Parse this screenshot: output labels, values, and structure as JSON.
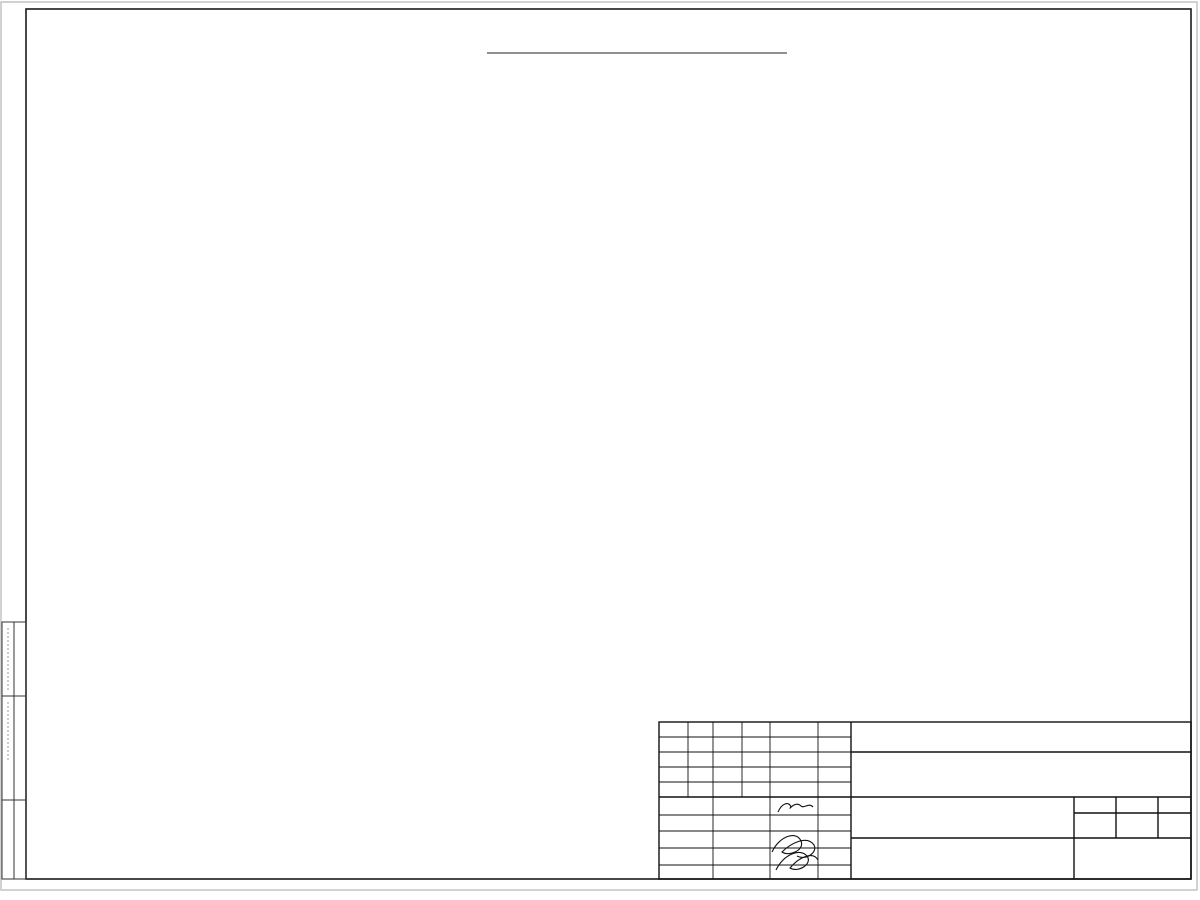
{
  "sheet": {
    "title": "Монтажный план этажа на отм. +3.480"
  },
  "axes": {
    "rows": [
      {
        "label": "Д",
        "y": 131
      },
      {
        "label": "Г",
        "y": 245
      },
      {
        "label": "В",
        "y": 358
      },
      {
        "label": "Б",
        "y": 471
      },
      {
        "label": "А",
        "y": 584
      }
    ],
    "cols": [
      {
        "label": "1",
        "x": 347
      },
      {
        "label": "2",
        "x": 438
      },
      {
        "label": "3",
        "x": 537
      },
      {
        "label": "4",
        "x": 623
      },
      {
        "label": "5",
        "x": 655
      },
      {
        "label": "6",
        "x": 738
      },
      {
        "label": "7",
        "x": 846
      },
      {
        "label": "8",
        "x": 953
      }
    ]
  },
  "dims": {
    "h": [
      {
        "t": "720",
        "x": 336,
        "y": 79
      },
      {
        "t": "1500",
        "x": 369,
        "y": 79
      },
      {
        "t": "1800",
        "x": 419,
        "y": 79
      },
      {
        "t": "1500",
        "x": 468,
        "y": 79
      },
      {
        "t": "1800",
        "x": 518,
        "y": 79
      },
      {
        "t": "1500",
        "x": 567,
        "y": 79
      },
      {
        "t": "1820",
        "x": 617,
        "y": 79
      },
      {
        "t": "1500",
        "x": 667,
        "y": 79
      },
      {
        "t": "1190",
        "x": 708,
        "y": 79
      },
      {
        "t": "1460",
        "x": 748,
        "y": 79
      },
      {
        "t": "4500",
        "x": 838,
        "y": 79
      },
      {
        "t": "1090",
        "x": 922,
        "y": 79
      },
      {
        "t": "230",
        "x": 729,
        "y": 119
      },
      {
        "t": "1000",
        "x": 760,
        "y": 119
      },
      {
        "t": "2820",
        "x": 687,
        "y": 157
      },
      {
        "t": "1780",
        "x": 763,
        "y": 157
      },
      {
        "t": "5400",
        "x": 872,
        "y": 157
      },
      {
        "t": "100",
        "x": 759,
        "y": 174
      },
      {
        "t": "100",
        "x": 815,
        "y": 174
      },
      {
        "t": "2000",
        "x": 770,
        "y": 509
      },
      {
        "t": "5180",
        "x": 876,
        "y": 509
      },
      {
        "t": "100",
        "x": 822,
        "y": 497
      },
      {
        "t": "950",
        "x": 748,
        "y": 566
      },
      {
        "t": "950",
        "x": 776,
        "y": 566
      },
      {
        "t": "100",
        "x": 782,
        "y": 554
      },
      {
        "t": "720",
        "x": 320,
        "y": 584
      },
      {
        "t": "720",
        "x": 336,
        "y": 605
      },
      {
        "t": "1500",
        "x": 369,
        "y": 605
      },
      {
        "t": "1800",
        "x": 418,
        "y": 605
      },
      {
        "t": "1500",
        "x": 468,
        "y": 605
      },
      {
        "t": "1800",
        "x": 517,
        "y": 605
      },
      {
        "t": "1500",
        "x": 566,
        "y": 605
      },
      {
        "t": "1800",
        "x": 616,
        "y": 605
      },
      {
        "t": "1500",
        "x": 665,
        "y": 605
      },
      {
        "t": "5600",
        "x": 774,
        "y": 605
      },
      {
        "t": "1500",
        "x": 881,
        "y": 605
      },
      {
        "t": "1160",
        "x": 921,
        "y": 605
      },
      {
        "t": "3000",
        "x": 392,
        "y": 622
      },
      {
        "t": "3300",
        "x": 487,
        "y": 622
      },
      {
        "t": "3300",
        "x": 582,
        "y": 622
      },
      {
        "t": "3000",
        "x": 687,
        "y": 622
      },
      {
        "t": "3600",
        "x": 792,
        "y": 622
      },
      {
        "t": "3600",
        "x": 899,
        "y": 622
      },
      {
        "t": "20140",
        "x": 588,
        "y": 641
      },
      {
        "t": "340",
        "x": 666,
        "y": 640
      }
    ],
    "v": [
      {
        "t": "15000",
        "x": 259,
        "y": 375
      },
      {
        "t": "15240",
        "x": 319,
        "y": 368
      },
      {
        "t": "3750",
        "x": 281,
        "y": 188
      },
      {
        "t": "3750",
        "x": 281,
        "y": 301
      },
      {
        "t": "3750",
        "x": 281,
        "y": 414
      },
      {
        "t": "3750",
        "x": 281,
        "y": 527
      },
      {
        "t": "1280",
        "x": 972,
        "y": 147
      },
      {
        "t": "1500",
        "x": 972,
        "y": 190
      },
      {
        "t": "2657",
        "x": 972,
        "y": 253
      },
      {
        "t": "1500",
        "x": 972,
        "y": 316
      },
      {
        "t": "1360",
        "x": 972,
        "y": 359
      },
      {
        "t": "1500",
        "x": 972,
        "y": 403
      },
      {
        "t": "2663",
        "x": 972,
        "y": 466
      },
      {
        "t": "1500",
        "x": 972,
        "y": 529
      },
      {
        "t": "1280",
        "x": 972,
        "y": 571
      },
      {
        "t": "1750",
        "x": 614,
        "y": 158
      },
      {
        "t": "1500",
        "x": 614,
        "y": 207
      },
      {
        "t": "2260",
        "x": 614,
        "y": 265
      },
      {
        "t": "1500",
        "x": 614,
        "y": 322
      },
      {
        "t": "4740",
        "x": 614,
        "y": 417
      },
      {
        "t": "1500",
        "x": 614,
        "y": 512
      },
      {
        "t": "1750",
        "x": 614,
        "y": 561
      },
      {
        "t": "5000",
        "x": 697,
        "y": 230
      },
      {
        "t": "4800",
        "x": 697,
        "y": 374
      },
      {
        "t": "5000",
        "x": 697,
        "y": 513
      },
      {
        "t": "100",
        "x": 676,
        "y": 263
      },
      {
        "t": "100",
        "x": 676,
        "y": 412
      },
      {
        "t": "1000",
        "x": 744,
        "y": 218
      },
      {
        "t": "1670",
        "x": 744,
        "y": 259
      },
      {
        "t": "2670",
        "x": 744,
        "y": 331
      },
      {
        "t": "1000",
        "x": 770,
        "y": 219
      },
      {
        "t": "500",
        "x": 770,
        "y": 260
      },
      {
        "t": "1000",
        "x": 770,
        "y": 326
      },
      {
        "t": "500",
        "x": 772,
        "y": 364
      },
      {
        "t": "1000",
        "x": 742,
        "y": 458
      },
      {
        "t": "1000",
        "x": 768,
        "y": 461
      },
      {
        "t": "200",
        "x": 780,
        "y": 442
      },
      {
        "t": "1350",
        "x": 799,
        "y": 389
      },
      {
        "t": "1250",
        "x": 799,
        "y": 427
      },
      {
        "t": "3830",
        "x": 925,
        "y": 194
      },
      {
        "t": "3647",
        "x": 925,
        "y": 311
      },
      {
        "t": "2700",
        "x": 925,
        "y": 404
      },
      {
        "t": "100",
        "x": 909,
        "y": 229
      },
      {
        "t": "100",
        "x": 909,
        "y": 345
      },
      {
        "t": "100",
        "x": 911,
        "y": 468
      },
      {
        "t": "4523",
        "x": 933,
        "y": 522
      }
    ]
  },
  "tb": {
    "code": "42-18-АР",
    "address1": "Здание фармацевтического склада, расположенное по адресу:",
    "address2": "Тюменская область, г. Тюмень, ул. Республики.",
    "org": "ООО \"Вектор-Восток\"",
    "doc1": "Монтажный план этажа на",
    "doc2": "отм. +3.480.",
    "firm": "ООО \"Альянс\"",
    "h_izm": "Изм.",
    "h_kol": "Кол.",
    "h_list": "Лист",
    "h_ndok": "№док.",
    "h_podp": "Подпись",
    "h_data": "Дата",
    "h_stadia": "Стадия",
    "h_sheet": "Лист",
    "h_sheets": "Листов",
    "stage": "ЭП",
    "sheet_no": "12",
    "r1_role": "Разработал",
    "r1_name": "Пупков",
    "r1_date": "01.19",
    "r2_role": "Н. контр.",
    "r2_name": "Двоеглазов",
    "r2_date": "01.19",
    "r3_role": "ГИП",
    "r3_name": "Коротаев",
    "r3_date": "01.19"
  }
}
